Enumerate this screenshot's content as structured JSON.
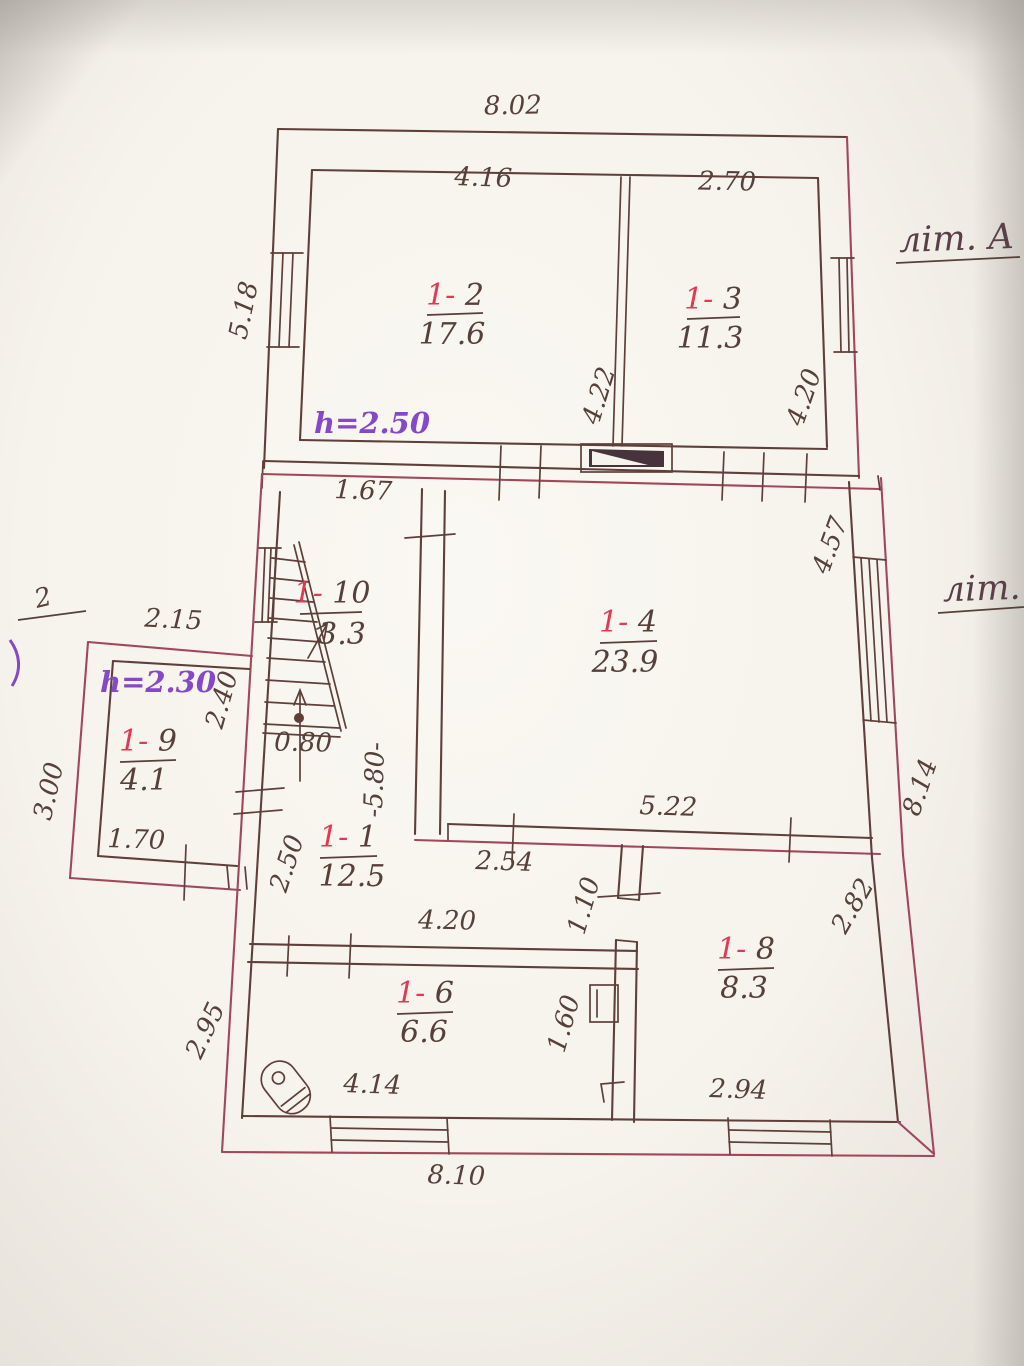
{
  "plan": {
    "lit_labels": {
      "main": "літ. А",
      "second": "літ."
    },
    "edge_fragment": {
      "text": "2"
    },
    "heights": {
      "attic": "h=2.50",
      "annex": "h=2.30"
    },
    "rooms": [
      {
        "prefix": "1-",
        "number": "2",
        "area": "17.6"
      },
      {
        "prefix": "1-",
        "number": "3",
        "area": "11.3"
      },
      {
        "prefix": "1-",
        "number": "4",
        "area": "23.9"
      },
      {
        "prefix": "1-",
        "number": "10",
        "area": "3.3"
      },
      {
        "prefix": "1-",
        "number": "9",
        "area": "4.1"
      },
      {
        "prefix": "1-",
        "number": "1",
        "area": "12.5"
      },
      {
        "prefix": "1-",
        "number": "6",
        "area": "6.6"
      },
      {
        "prefix": "1-",
        "number": "8",
        "area": "8.3"
      }
    ],
    "dims": {
      "building_top_width": "8.02",
      "room_1_2_width": "4.16",
      "room_1_3_width": "2.70",
      "top_left_height": "5.18",
      "room_1_2_height": "4.22",
      "room_1_3_height": "4.20",
      "hall_offset": "1.67",
      "room_1_4_height": "4.57",
      "room_1_4_width": "5.22",
      "corridor_width_upper": "2.54",
      "stairs_width": "0.80",
      "middle_height": "-5.80-",
      "annex_width": "2.15",
      "annex_room_height": "2.40",
      "annex_left_height": "3.00",
      "annex_room_width": "1.70",
      "corridor_height": "2.50",
      "corridor_lower_width": "4.20",
      "door_1_8": "1.10",
      "room_1_6_height_right": "1.60",
      "room_1_8_right": "2.82",
      "right_side_height": "8.14",
      "bottom_left_height": "2.95",
      "room_1_6_width": "4.14",
      "room_1_8_width": "2.94",
      "building_bottom_width": "8.10"
    },
    "colors": {
      "ink": "#5f3f3a",
      "wall_red": "#a2475a",
      "room_red": "#e03a52",
      "height_purple": "#8448c8",
      "paper": "#f6f3ec"
    }
  }
}
